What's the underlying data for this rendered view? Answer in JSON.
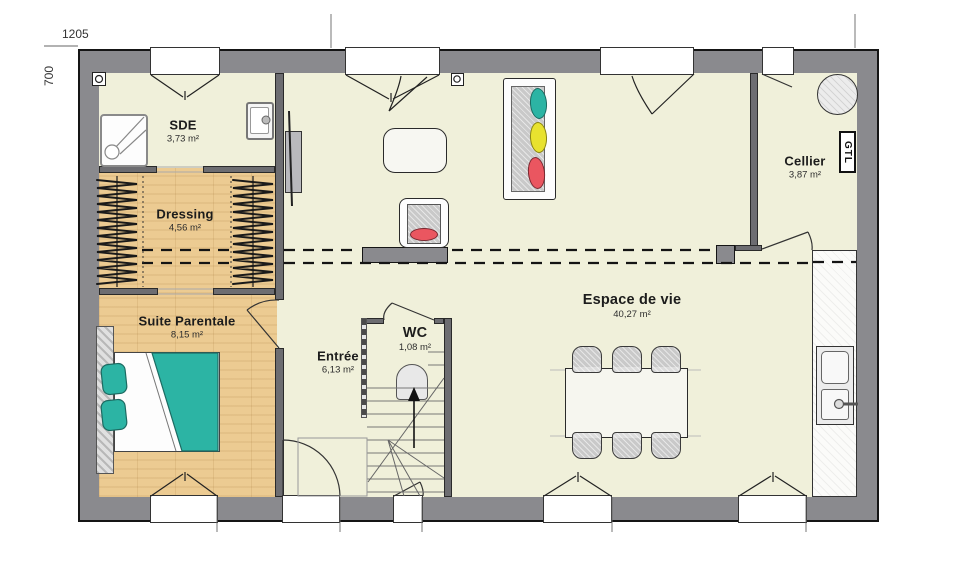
{
  "dimensions": {
    "width": "1205",
    "height": "700"
  },
  "rooms": [
    {
      "id": "sde",
      "name": "SDE",
      "area": "3,73 m²"
    },
    {
      "id": "dressing",
      "name": "Dressing",
      "area": "4,56 m²"
    },
    {
      "id": "suite",
      "name": "Suite Parentale",
      "area": "8,15 m²"
    },
    {
      "id": "entree",
      "name": "Entrée",
      "area": "6,13 m²"
    },
    {
      "id": "wc",
      "name": "WC",
      "area": "1,08 m²"
    },
    {
      "id": "espace",
      "name": "Espace de vie",
      "area": "40,27 m²"
    },
    {
      "id": "cellier",
      "name": "Cellier",
      "area": "3,87 m²"
    }
  ],
  "labels": {
    "gtl": "GTL"
  },
  "colors": {
    "wall": "#8a8a8e",
    "floor": "#f0f0da",
    "wood_floor": "#eccb92",
    "bed_teal": "#2cb4a4",
    "cushion_yellow": "#e8e22f",
    "cushion_red": "#ea5660"
  }
}
